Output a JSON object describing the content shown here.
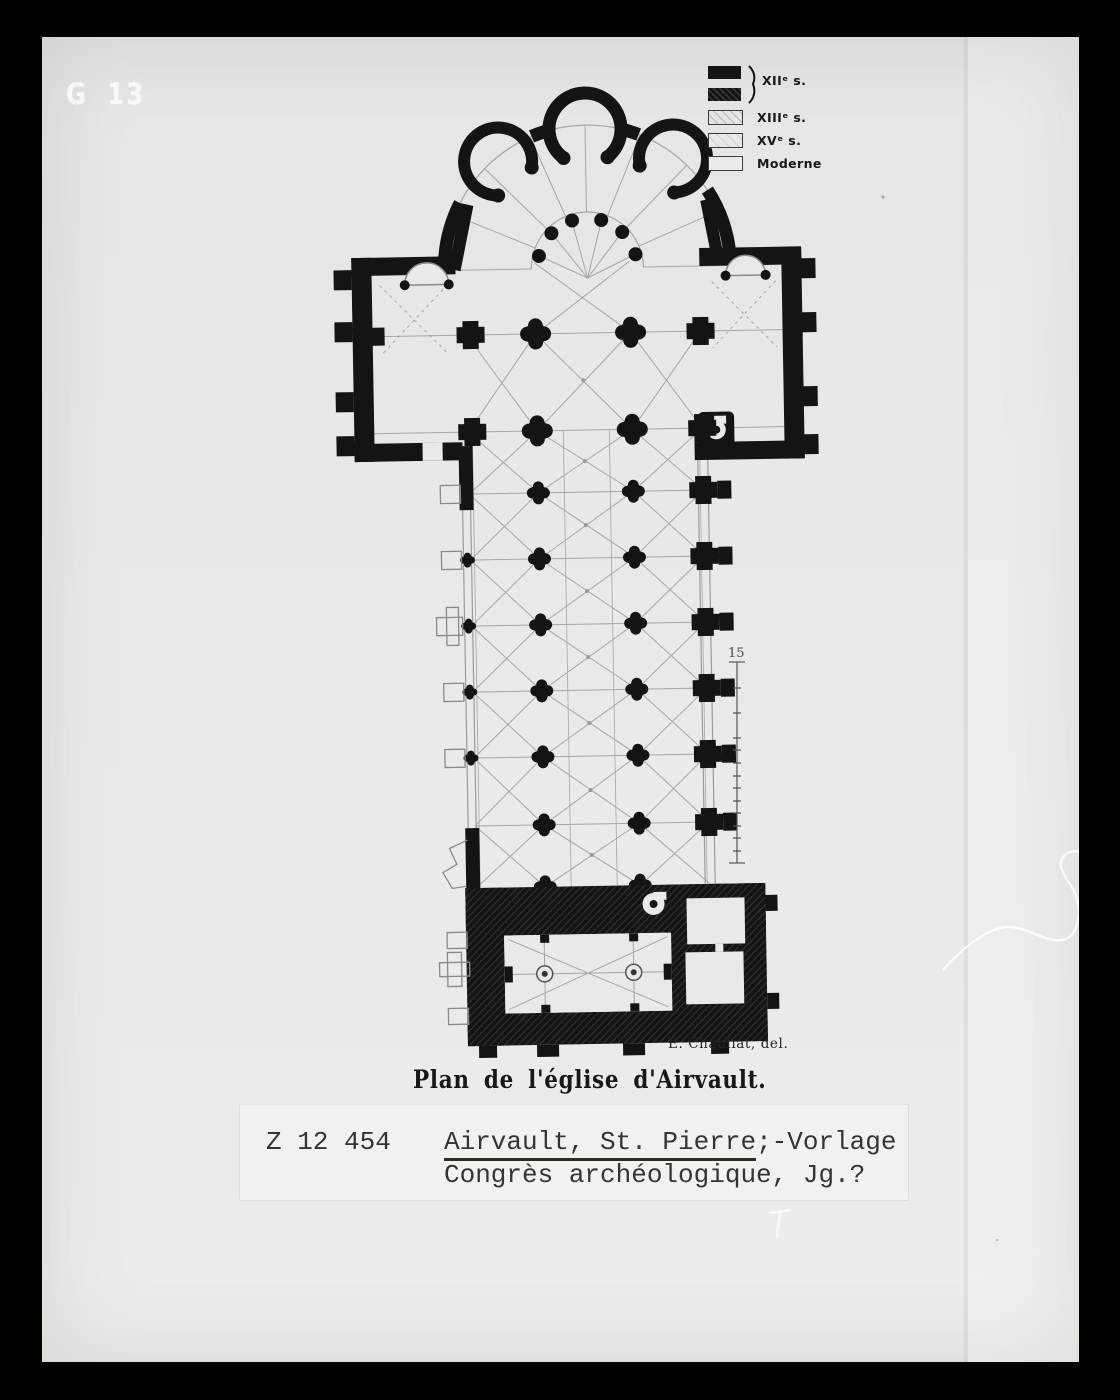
{
  "photo": {
    "corner_mark": "G 13"
  },
  "legend": {
    "items": [
      {
        "label": "XIIᵉ s.",
        "swatches": [
          "solid-black",
          "hatched-black"
        ]
      },
      {
        "label": "XIIIᵉ s.",
        "swatches": [
          "light-hatch"
        ]
      },
      {
        "label": "XVᵉ s.",
        "swatches": [
          "pale-hatch"
        ]
      },
      {
        "label": "Moderne",
        "swatches": [
          "outline"
        ]
      }
    ]
  },
  "scale_bar": {
    "top_label": "15"
  },
  "captions": {
    "artist_credit": "E. Chauliat, del.",
    "plan_title": "Plan de l'église d'Airvault."
  },
  "catalog_label": {
    "inventory_number": "Z 12 454",
    "title_underlined": "Airvault, St. Pierre",
    "title_suffix": ";-Vorlage",
    "line2": "Congrès archéologique, Jg.?"
  },
  "colors": {
    "film_frame": "#020202",
    "paper": "#e9e9e7",
    "ink": "#141414",
    "rib_line": "#a6a6a6"
  }
}
